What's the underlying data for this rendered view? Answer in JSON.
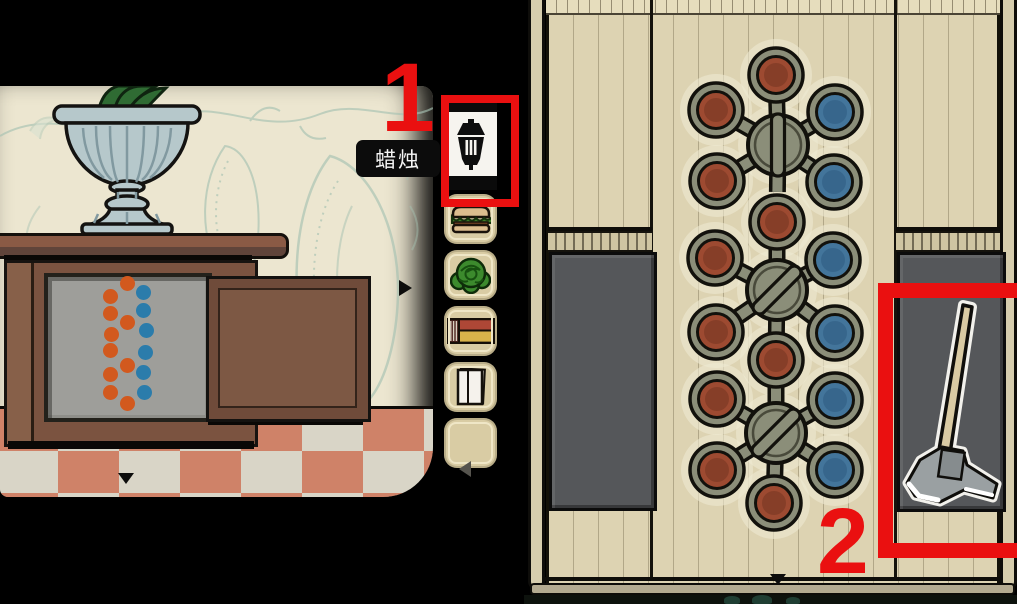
{
  "annotation": {
    "color": "#ea1010",
    "step1": "1",
    "step2": "2"
  },
  "tooltip": {
    "text": "蜡烛"
  },
  "left_scene": {
    "nav_right_icon": "right-arrow",
    "nav_down_icon": "down-arrow",
    "dot_colors": {
      "orange": "#d2591e",
      "blue": "#2b7cab"
    },
    "dots": [
      {
        "x": 127,
        "y": 197,
        "c": "orange"
      },
      {
        "x": 110,
        "y": 210,
        "c": "orange"
      },
      {
        "x": 143,
        "y": 206,
        "c": "blue"
      },
      {
        "x": 110,
        "y": 227,
        "c": "orange"
      },
      {
        "x": 143,
        "y": 224,
        "c": "blue"
      },
      {
        "x": 127,
        "y": 236,
        "c": "orange"
      },
      {
        "x": 111,
        "y": 248,
        "c": "orange"
      },
      {
        "x": 146,
        "y": 244,
        "c": "blue"
      },
      {
        "x": 110,
        "y": 264,
        "c": "orange"
      },
      {
        "x": 145,
        "y": 266,
        "c": "blue"
      },
      {
        "x": 127,
        "y": 279,
        "c": "orange"
      },
      {
        "x": 110,
        "y": 288,
        "c": "orange"
      },
      {
        "x": 143,
        "y": 286,
        "c": "blue"
      },
      {
        "x": 110,
        "y": 306,
        "c": "orange"
      },
      {
        "x": 144,
        "y": 306,
        "c": "blue"
      },
      {
        "x": 127,
        "y": 317,
        "c": "orange"
      }
    ]
  },
  "inventory": {
    "selected": {
      "name": "candle-lantern",
      "label": "蜡烛"
    },
    "items": [
      {
        "name": "sandwich"
      },
      {
        "name": "lettuce"
      },
      {
        "name": "matchbox"
      },
      {
        "name": "paper"
      },
      {
        "name": "empty"
      }
    ],
    "prev_icon": "left-arrow"
  },
  "right_scene": {
    "axe_item": "axe",
    "nav_down_icon": "down-arrow",
    "puzzle": {
      "colors": {
        "red": "#9d4a31",
        "red_dark": "#833c27",
        "blue": "#43759b",
        "blue_dark": "#35648a",
        "valve": "#8b8e79",
        "outline": "#12110c",
        "halo": "#efe9d2"
      },
      "knobs": [
        {
          "x": 190,
          "y": 45,
          "c": "red"
        },
        {
          "x": 191,
          "y": 192,
          "c": "red"
        },
        {
          "x": 190,
          "y": 330,
          "c": "red"
        },
        {
          "x": 188,
          "y": 473,
          "c": "red"
        },
        {
          "x": 130,
          "y": 80,
          "c": "red"
        },
        {
          "x": 131,
          "y": 151,
          "c": "red"
        },
        {
          "x": 249,
          "y": 82,
          "c": "blue"
        },
        {
          "x": 248,
          "y": 152,
          "c": "blue"
        },
        {
          "x": 129,
          "y": 228,
          "c": "red"
        },
        {
          "x": 130,
          "y": 302,
          "c": "red"
        },
        {
          "x": 247,
          "y": 230,
          "c": "blue"
        },
        {
          "x": 249,
          "y": 303,
          "c": "blue"
        },
        {
          "x": 131,
          "y": 369,
          "c": "red"
        },
        {
          "x": 131,
          "y": 440,
          "c": "red"
        },
        {
          "x": 249,
          "y": 370,
          "c": "blue"
        },
        {
          "x": 249,
          "y": 440,
          "c": "blue"
        }
      ],
      "clusters": [
        {
          "x": 192,
          "y": 115,
          "bar": 90,
          "knobs": [
            0,
            4,
            6,
            5,
            7,
            1
          ]
        },
        {
          "x": 191,
          "y": 260,
          "bar": -45,
          "knobs": [
            1,
            8,
            10,
            9,
            11,
            2
          ]
        },
        {
          "x": 190,
          "y": 403,
          "bar": -45,
          "knobs": [
            2,
            12,
            14,
            13,
            15,
            3
          ]
        }
      ]
    }
  }
}
